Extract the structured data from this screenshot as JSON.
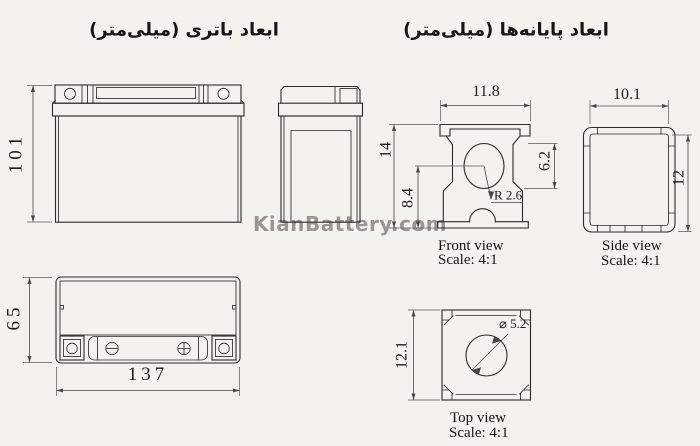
{
  "titles": {
    "battery_dimensions": "ابعاد باتری (میلی‌متر)",
    "terminal_dimensions": "ابعاد پایانه‌ها (میلی‌متر)"
  },
  "watermark": {
    "text": "KianBattery.com"
  },
  "battery": {
    "front": {
      "height": "101"
    },
    "top": {
      "height": "65",
      "width": "137"
    }
  },
  "terminal": {
    "front": {
      "width": "11.8",
      "height": "14",
      "center_height": "8.4",
      "hole_height": "6.2",
      "radius": "R 2.6",
      "caption": "Front view",
      "scale": "Scale:  4:1"
    },
    "side": {
      "width": "10.1",
      "height": "12",
      "caption": "Side view",
      "scale": "Scale:  4:1"
    },
    "top": {
      "height": "12.1",
      "hole_diameter": "⌀ 5.2",
      "caption": "Top view",
      "scale": "Scale:  4:1"
    }
  },
  "colors": {
    "background": "#f4f2ec",
    "line": "#2b2b2b",
    "dimension": "#474747",
    "watermark": "#7d7973"
  }
}
